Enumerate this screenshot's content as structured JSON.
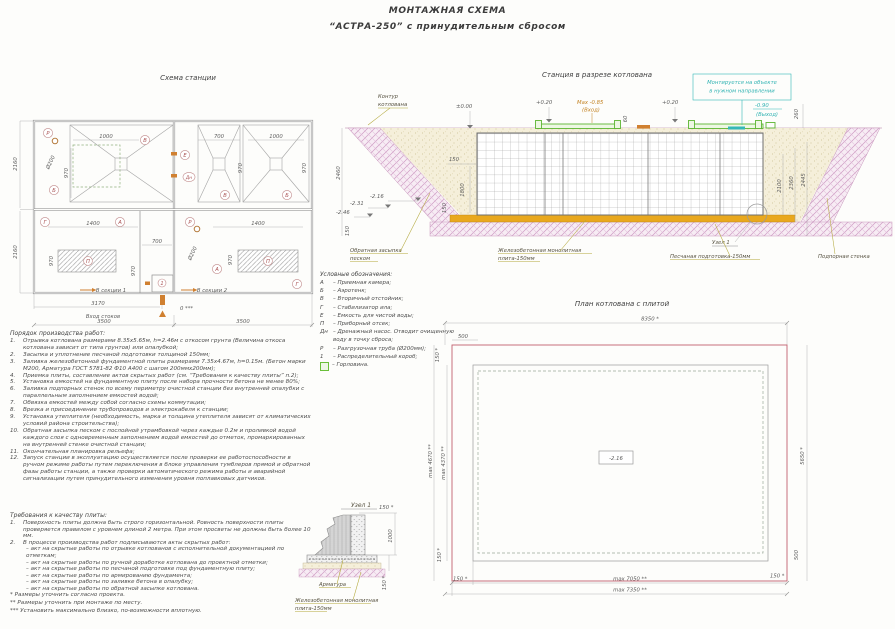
{
  "header": {
    "title": "МОНТАЖНАЯ СХЕМА",
    "subtitle": "“АСТРА-250” с принудительным сбросом"
  },
  "plan": {
    "title": "Схема станции",
    "letters": {
      "R": "Р",
      "B": "Б",
      "V": "В",
      "G": "Г",
      "A": "А",
      "P": "П",
      "E": "Е",
      "DN": "Дн",
      "ONE": "1"
    },
    "dims": {
      "d1000": "1000",
      "d700": "700",
      "d970": "970",
      "d1400": "1400",
      "d200": "Ø200",
      "d2160": "2160",
      "d3170": "3170",
      "d3500": "3500",
      "zero": "0 ***"
    },
    "inlet": "Вход стоков",
    "sec1": "В секции 1",
    "sec2": "В секции 2"
  },
  "section": {
    "title": "Станция в разрезе котлована",
    "contour1": "Контур",
    "contour2": "котлована",
    "lvl0": "±0.00",
    "lvl020": "+0.20",
    "max1": "Max -0.85",
    "max2": "(Вход)",
    "note1": "Монтируется на объекте",
    "note2": "в нужном направлении",
    "out1": "-0.90",
    "out2": "(Выход)",
    "backfill1": "Обратная засыпка",
    "backfill2": "песком",
    "slab1": "Железобетонная монолитная",
    "slab2": "плита-150мм",
    "node": "Узел 1",
    "sand": "Песчаная подготовка-150мм",
    "wall": "Подпорная стенка",
    "dims": {
      "d2460": "2460",
      "d60": "60",
      "d260": "260",
      "d150": "150",
      "d1800": "1800",
      "d2100": "2100",
      "d2360": "2360",
      "d2445": "2445",
      "e216": "-2.16",
      "e231": "-2.31",
      "e246": "-2.46"
    }
  },
  "legend": {
    "title": "Условные обозначения:",
    "items": [
      {
        "sym": "А",
        "text": "–  Приемная камера;"
      },
      {
        "sym": "Б",
        "text": "–  Аэротенк;"
      },
      {
        "sym": "В",
        "text": "–  Вторичный отстойник;"
      },
      {
        "sym": "Г",
        "text": "–  Стабилизатор ила;"
      },
      {
        "sym": "Е",
        "text": "–  Емкость для чистой воды;"
      },
      {
        "sym": "П",
        "text": "–  Приборный отсек;"
      },
      {
        "sym": "Дн",
        "text": "–  Дренажный насос. Отводит очищенную воду в точку сброса;"
      },
      {
        "sym": "Р",
        "text": "–  Разгрузочная труба (Ø200мм);"
      },
      {
        "sym": "1",
        "text": "–  Распределительный короб;"
      },
      {
        "sym": "",
        "text": "–  Горловина."
      }
    ]
  },
  "work": {
    "title": "Порядок производства работ:",
    "items": [
      {
        "n": "1.",
        "t": "Отрывка котлована размерами 8.35х5.65м, h=2.46м с откосом грунта (Величина откоса котлована зависит от типа грунтов) или опалубкой;"
      },
      {
        "n": "2.",
        "t": "Засыпка и уплотнение песчаной подготовки толщиной 150мм;"
      },
      {
        "n": "3.",
        "t": "Заливка железобетонной фундаментной плиты размерами 7.35х4.67м, h=0.15м. (Бетон марки М200, Арматура ГОСТ 5781-82 Ф10 А400 с шагом 200ммх200мм);"
      },
      {
        "n": "4.",
        "t": "Приемка плиты, составление актов скрытых работ (см. “Требования к качеству плиты” п.2);"
      },
      {
        "n": "5.",
        "t": "Установка емкостей на фундаментную плиту после набора прочности бетона не менее 80%;"
      },
      {
        "n": "6.",
        "t": "Заливка подпорных стенок по всему периметру очистной станции без внутренней опалубки с параллельным заполнением емкостей водой;"
      },
      {
        "n": "7.",
        "t": "Обвязка емкостей между собой согласно схемы коммутации;"
      },
      {
        "n": "8.",
        "t": "Врезка и присоединение трубопроводов и электрокабеля к станции;"
      },
      {
        "n": "9.",
        "t": "Установка утеплителя (необходимость, марка и толщина утеплителя зависят от климатических условий района строительства);"
      },
      {
        "n": "10.",
        "t": "Обратная засыпка песком с послойной утрамбовкой через каждые 0.2м и проливкой водой каждого слоя с одновременным заполнением водой емкостей до отметок, промаркированных на внутренней стенке очистной станции;"
      },
      {
        "n": "11.",
        "t": "Окончательная планировка рельефа;"
      },
      {
        "n": "12.",
        "t": "Запуск станции в эксплуатацию осуществляется после проверки ее работоспособности в ручном режиме работы путем переключения в блоке управления тумблеров прямой и обратной фазы работы станции, а также проверки автоматического режима работы и аварийной сигнализации путем принудительного изменения уровня поплавковых датчиков."
      }
    ]
  },
  "req": {
    "title": "Требования к качеству плиты:",
    "items": [
      {
        "n": "1.",
        "t": "Поверхность плиты должна быть строго горизонтальной. Ровность поверхности плиты проверяется правилом с уровнем длиной 2 метра. При этом просветы не должны быть более 10 мм."
      },
      {
        "n": "2.",
        "t": "В процессе производства работ подписываются акты скрытых работ:"
      }
    ],
    "acts": [
      "– акт на скрытые работы по отрывке котлованов с исполнительной документацией по отметкам;",
      "– акт на скрытые работы по ручной доработке котлована до проектной отметки;",
      "– акт на скрытые работы по песчаной подготовке под фундаментную плиту;",
      "– акт на скрытые работы по армированию фундамента;",
      "– акт на скрытые работы по заливке бетона в опалубку;",
      "– акт на скрытые работы по обратной засыпке котлована."
    ]
  },
  "footnotes": [
    "*  Размеры уточнить согласно проекта.",
    "**  Размеры уточнить при монтаже по месту.",
    "***  Установить максимально близко, по-возможности вплотную."
  ],
  "pitplan": {
    "title": "План котлована с плитой",
    "dims": {
      "d8350": "8350 *",
      "d500": "500",
      "d150": "150 *",
      "d4670": "max 4670 **",
      "d4370": "max 4370 **",
      "d5650": "5650 *",
      "d7050": "max 7050 **",
      "d7350": "max 7350 **",
      "e216": "-2.16"
    }
  },
  "node": {
    "title": "Узел 1",
    "dims": {
      "d150": "150 *",
      "d1000": "1000"
    },
    "labels": {
      "rebar": "Арматура",
      "slab1": "Железобетонная монолитная",
      "slab2": "плита-150мм"
    }
  }
}
